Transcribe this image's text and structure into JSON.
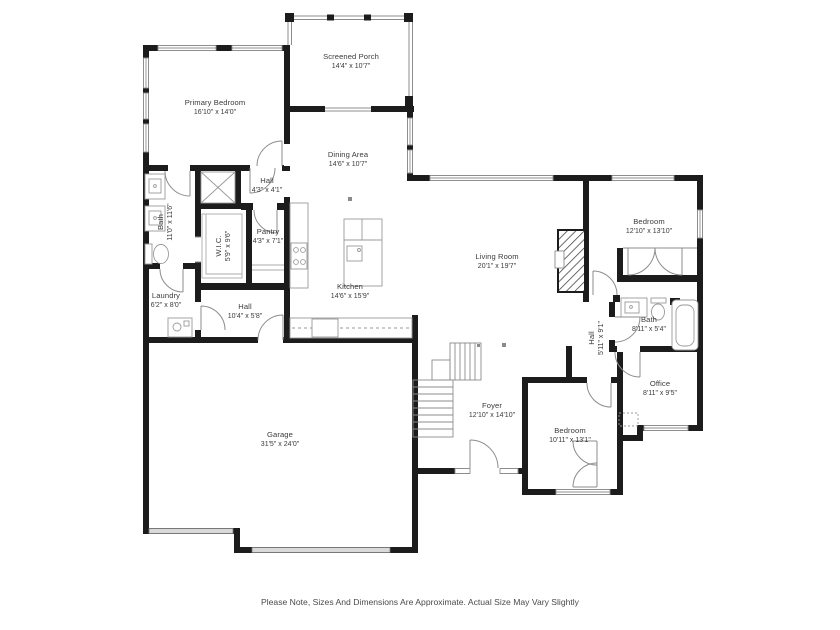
{
  "note": {
    "text": "Please Note, Sizes And Dimensions Are Approximate. Actual Size May Vary Slightly"
  },
  "colors": {
    "wall": "#1c1c1c",
    "line": "#8c8c8c",
    "window_fill": "#ffffff",
    "garage_door": "#d9d9d9",
    "text": "#3b3b3b"
  },
  "rooms": [
    {
      "id": "screened-porch",
      "name": "Screened Porch",
      "dims": "14'4\" x 10'7\""
    },
    {
      "id": "primary-bedroom",
      "name": "Primary Bedroom",
      "dims": "16'10\" x 14'0\""
    },
    {
      "id": "dining-area",
      "name": "Dining Area",
      "dims": "14'6\" x 10'7\""
    },
    {
      "id": "hall-primary",
      "name": "Hall",
      "dims": "4'3\" x 4'1\""
    },
    {
      "id": "bath-primary",
      "name": "Bath",
      "dims": "11'0\" x 11'6\""
    },
    {
      "id": "wic",
      "name": "W.I.C.",
      "dims": "5'9\" x 9'6\""
    },
    {
      "id": "pantry",
      "name": "Pantry",
      "dims": "4'3\" x 7'1\""
    },
    {
      "id": "kitchen",
      "name": "Kitchen",
      "dims": "14'6\" x 15'9\""
    },
    {
      "id": "living-room",
      "name": "Living Room",
      "dims": "20'1\" x 19'7\""
    },
    {
      "id": "bedroom-1",
      "name": "Bedroom",
      "dims": "12'10\" x 13'10\""
    },
    {
      "id": "hall-right",
      "name": "Hall",
      "dims": "5'11\" x 9'1\""
    },
    {
      "id": "bath-right",
      "name": "Bath",
      "dims": "8'11\" x 5'4\""
    },
    {
      "id": "office",
      "name": "Office",
      "dims": "8'11\" x 9'5\""
    },
    {
      "id": "laundry",
      "name": "Laundry",
      "dims": "6'2\" x 8'0\""
    },
    {
      "id": "hall-bottom",
      "name": "Hall",
      "dims": "10'4\" x 5'8\""
    },
    {
      "id": "foyer",
      "name": "Foyer",
      "dims": "12'10\" x 14'10\""
    },
    {
      "id": "bedroom-2",
      "name": "Bedroom",
      "dims": "10'11\" x 13'1\""
    },
    {
      "id": "garage",
      "name": "Garage",
      "dims": "31'5\" x 24'0\""
    }
  ]
}
